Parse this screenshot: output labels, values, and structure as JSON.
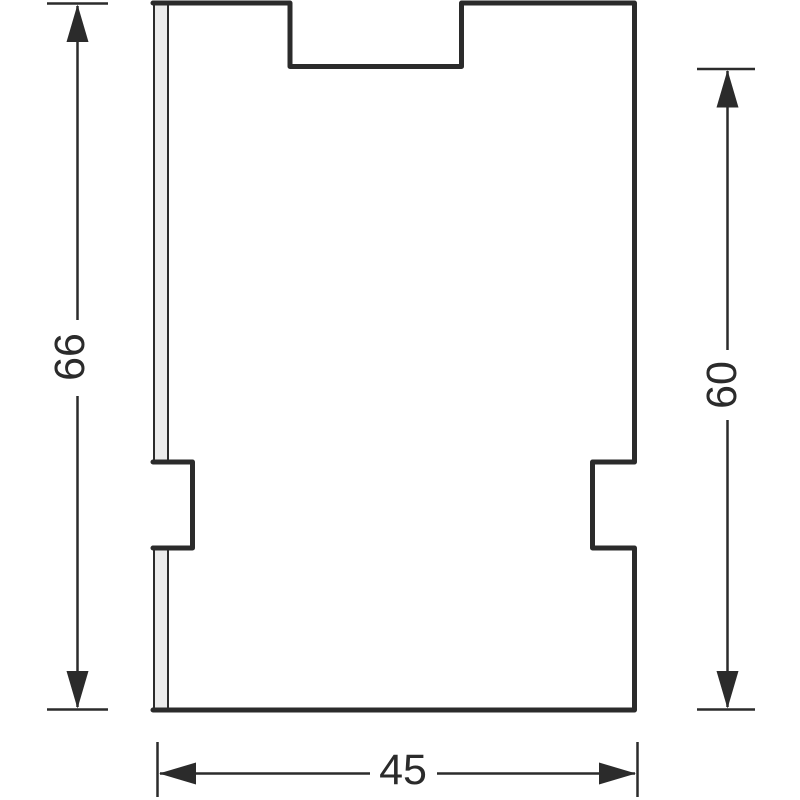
{
  "diagram": {
    "type": "technical-drawing-dimensioned-plate",
    "labels": {
      "height_total": "66",
      "height_right": "60",
      "width_bottom": "45"
    },
    "colors": {
      "line": "#2b2b2b",
      "dim_line": "#2b2b2b",
      "strip_fill": "#ececec",
      "background": "#ffffff"
    }
  }
}
